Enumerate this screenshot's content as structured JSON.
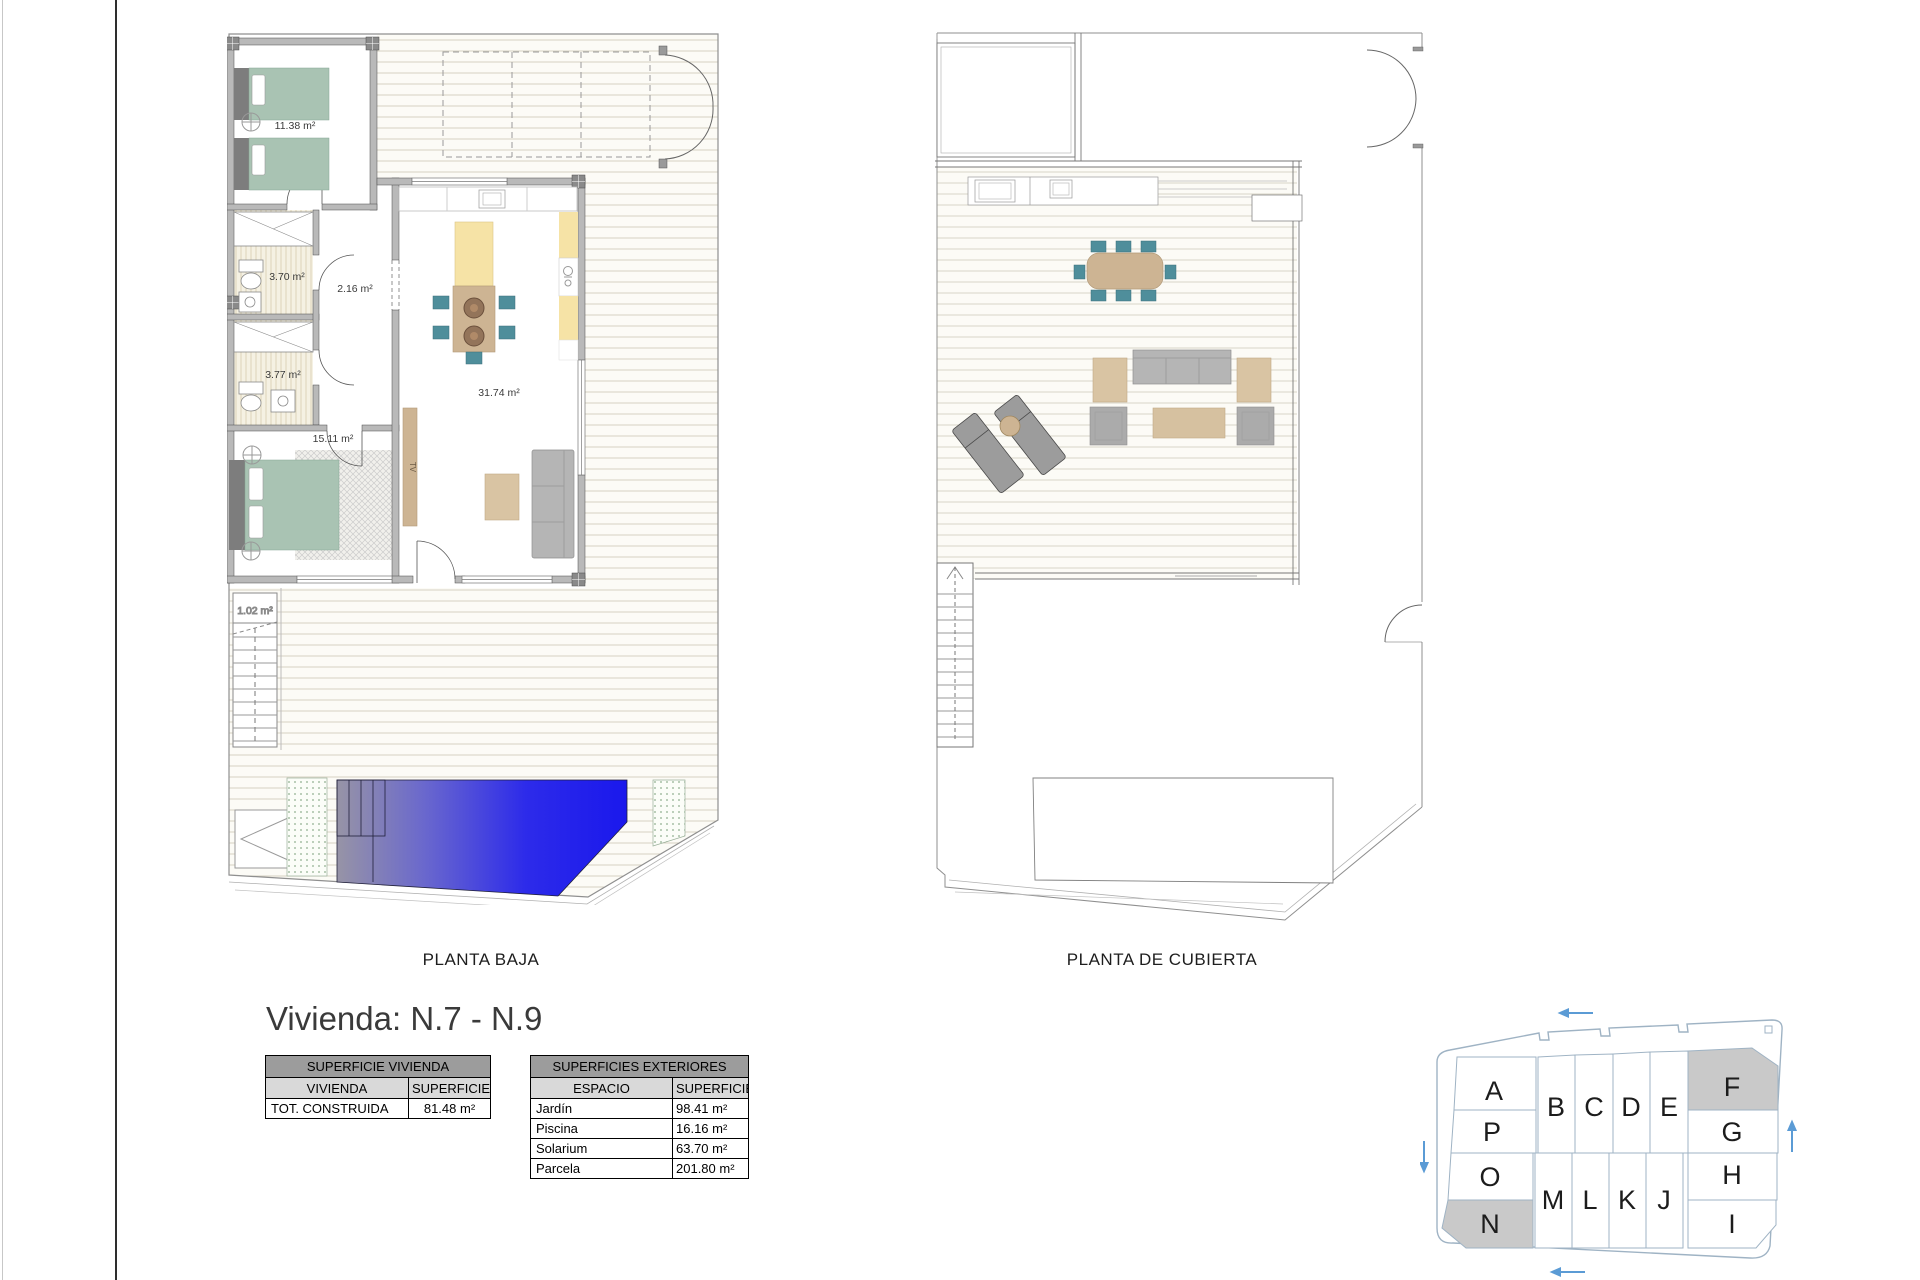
{
  "title": "Vivienda: N.7 - N.9",
  "plans": {
    "baja": {
      "caption": "PLANTA BAJA",
      "areas": {
        "bedroom1": "11.38 m²",
        "bath1": "3.70 m²",
        "hall": "2.16 m²",
        "bath2": "3.77 m²",
        "bedroom2": "15.11 m²",
        "living": "31.74 m²",
        "storage": "1.02 m²"
      },
      "tv_label": "TV"
    },
    "cubierta": {
      "caption": "PLANTA DE CUBIERTA"
    }
  },
  "surface_tables": {
    "vivienda": {
      "title": "SUPERFICIE VIVIENDA",
      "col1": "VIVIENDA",
      "col2": "SUPERFICIE",
      "rows": [
        {
          "name": "TOT. CONSTRUIDA",
          "value": "81.48 m²"
        }
      ]
    },
    "exteriores": {
      "title": "SUPERFICIES EXTERIORES",
      "col1": "ESPACIO",
      "col2": "SUPERFICIE",
      "rows": [
        {
          "name": "Jardín",
          "value": "98.41 m²"
        },
        {
          "name": "Piscina",
          "value": "16.16 m²"
        },
        {
          "name": "Solarium",
          "value": "63.70 m²"
        },
        {
          "name": "Parcela",
          "value": "201.80 m²"
        }
      ]
    }
  },
  "site_plan": {
    "plots": [
      {
        "label": "A",
        "highlighted": false
      },
      {
        "label": "P",
        "highlighted": false
      },
      {
        "label": "O",
        "highlighted": false
      },
      {
        "label": "N",
        "highlighted": true
      },
      {
        "label": "B",
        "highlighted": false
      },
      {
        "label": "C",
        "highlighted": false
      },
      {
        "label": "D",
        "highlighted": false
      },
      {
        "label": "E",
        "highlighted": false
      },
      {
        "label": "M",
        "highlighted": false
      },
      {
        "label": "L",
        "highlighted": false
      },
      {
        "label": "K",
        "highlighted": false
      },
      {
        "label": "J",
        "highlighted": false
      },
      {
        "label": "F",
        "highlighted": true
      },
      {
        "label": "G",
        "highlighted": false
      },
      {
        "label": "H",
        "highlighted": false
      },
      {
        "label": "I",
        "highlighted": false
      }
    ],
    "highlight_color": "#c9c9c9",
    "line_color": "#9fb3c4",
    "arrow_color": "#5b9bd5"
  },
  "colors": {
    "wall": "#b9b9b9",
    "bed_green": "#a9c3b3",
    "chair_teal": "#4f8e9b",
    "wood_tan": "#cdb493",
    "kitchen_yellow": "#f6e3a6",
    "sofa_grey": "#b5b5b5",
    "pool_blue": "#1a18ec"
  }
}
